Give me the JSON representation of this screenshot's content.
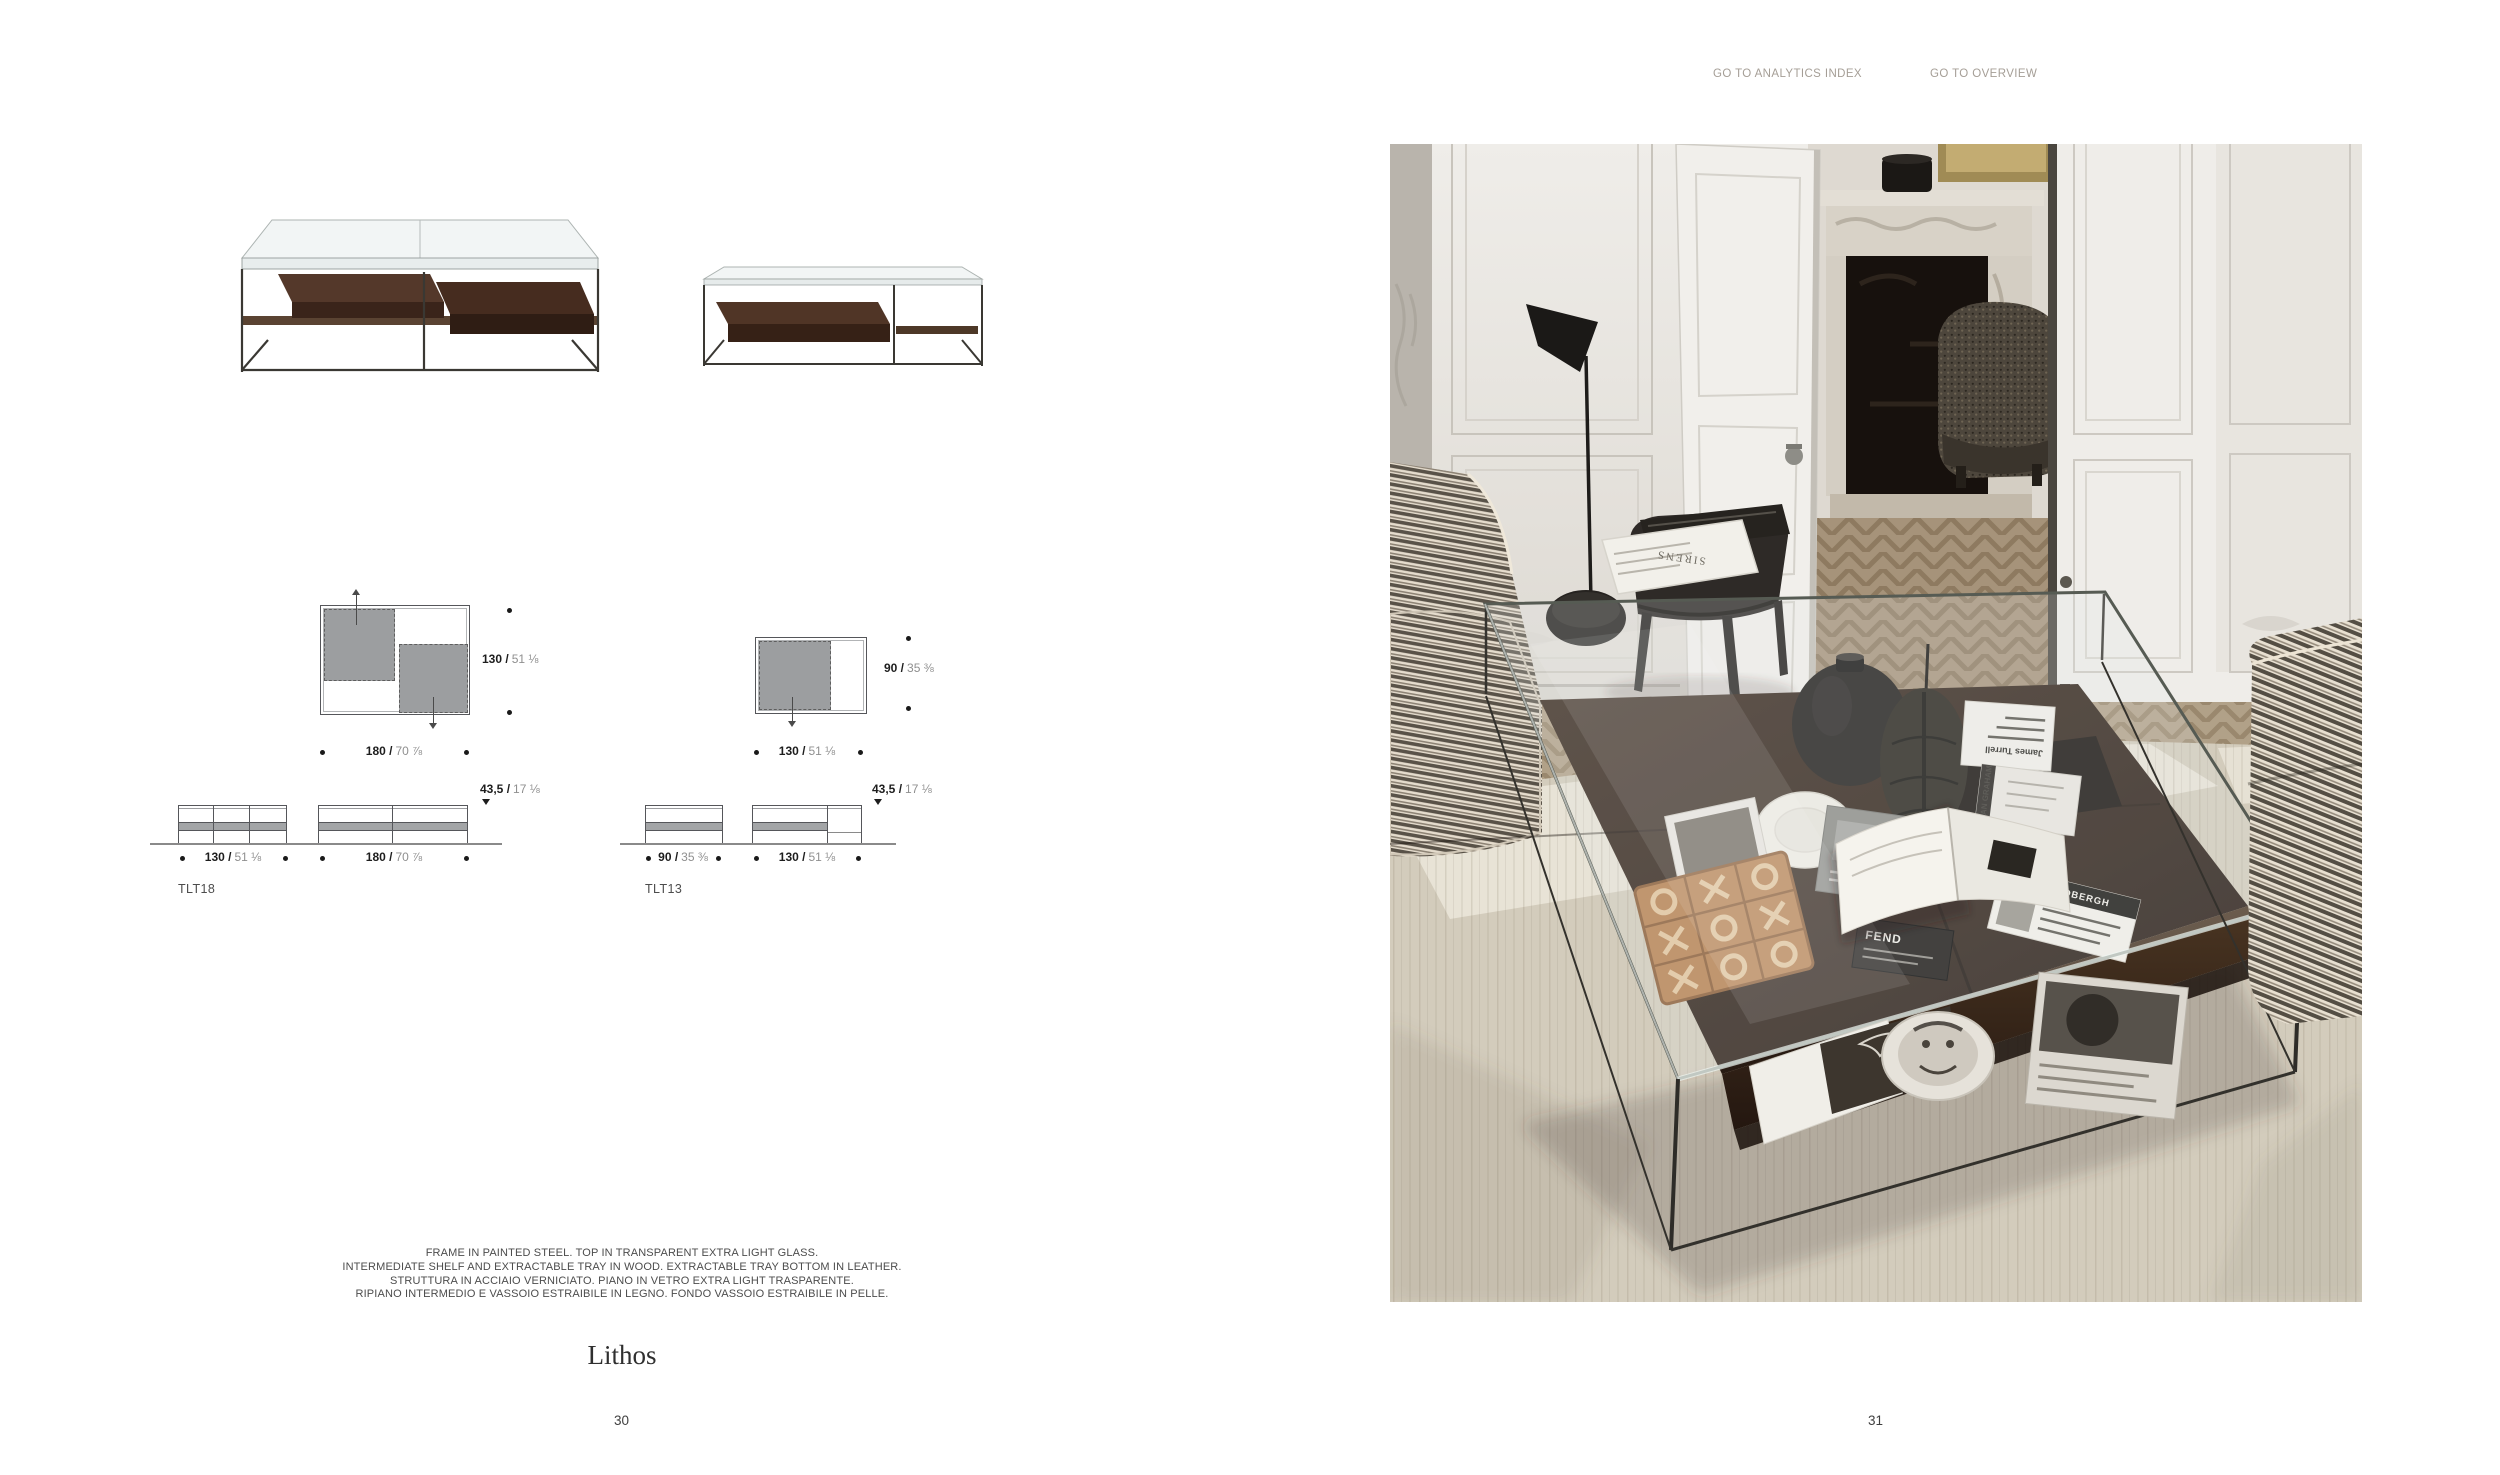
{
  "nav": {
    "analytics": "GO TO ANALYTICS INDEX",
    "overview": "GO TO OVERVIEW"
  },
  "products": [
    {
      "code": "TLT18",
      "plan": {
        "width_cm": "180 /",
        "width_in": "70 ⅞",
        "depth_cm": "130 /",
        "depth_in": "51 ⅛"
      },
      "elev": [
        {
          "cm": "130 /",
          "in": "51 ⅛"
        },
        {
          "cm": "180 /",
          "in": "70 ⅞"
        }
      ],
      "height_cm": "43,5 /",
      "height_in": "17 ⅛"
    },
    {
      "code": "TLT13",
      "plan": {
        "width_cm": "130 /",
        "width_in": "51 ⅛",
        "depth_cm": "90 /",
        "depth_in": "35 ⅜"
      },
      "elev": [
        {
          "cm": "90 /",
          "in": "35 ⅜"
        },
        {
          "cm": "130 /",
          "in": "51 ⅛"
        }
      ],
      "height_cm": "43,5 /",
      "height_in": "17 ⅛"
    }
  ],
  "description": {
    "line1": "FRAME IN PAINTED STEEL. TOP IN TRANSPARENT EXTRA LIGHT GLASS.",
    "line2": "INTERMEDIATE SHELF AND EXTRACTABLE TRAY IN WOOD. EXTRACTABLE TRAY BOTTOM IN LEATHER.",
    "line3": "STRUTTURA IN ACCIAIO VERNICIATO. PIANO IN VETRO EXTRA LIGHT TRASPARENTE.",
    "line4": "RIPIANO INTERMEDIO E VASSOIO ESTRAIBILE IN LEGNO. FONDO VASSOIO ESTRAIBILE IN PELLE."
  },
  "collection": "Lithos",
  "pages": {
    "left": "30",
    "right": "31"
  },
  "photo_books": {
    "sirens": "SIRENS",
    "turrell": "James Turrell",
    "graham": "DAN GRAHAM",
    "scandinavia": "Scandinavia",
    "fendi": "FEND",
    "lindbergh": "PETER LINDBERGH"
  },
  "colors": {
    "nav_text": "#a59e96",
    "dim_bold": "#1d1d1d",
    "dim_light": "#8f8f8f",
    "tray_gray": "#9c9ea0",
    "wood_dark": "#33241a",
    "steel": "#35332f"
  }
}
